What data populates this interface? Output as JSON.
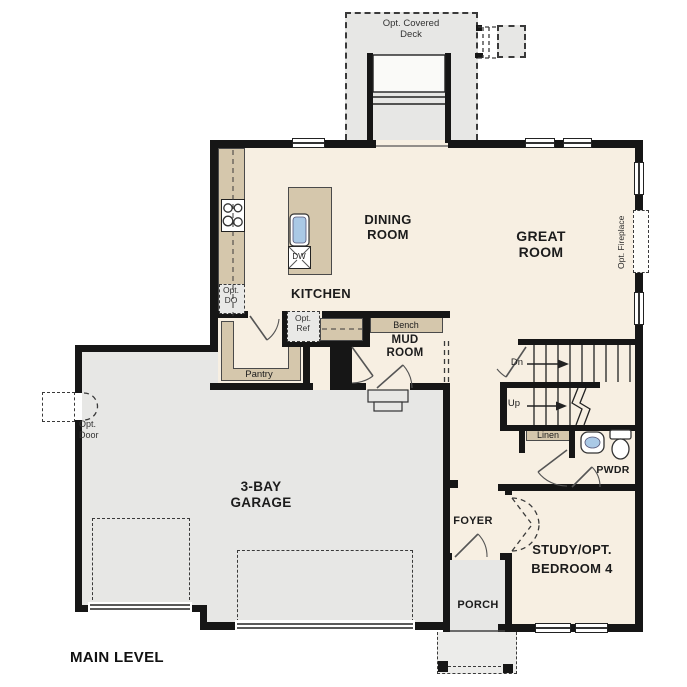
{
  "title": "MAIN LEVEL",
  "colors": {
    "floor": "#f7efe2",
    "garage_floor": "#e7e7e5",
    "cabinetry": "#d5c7ac",
    "wall": "#161616",
    "fixture_blue": "#aac9e6"
  },
  "rooms": {
    "kitchen": {
      "label": "KITCHEN"
    },
    "dining": {
      "line1": "DINING",
      "line2": "ROOM"
    },
    "great": {
      "line1": "GREAT",
      "line2": "ROOM"
    },
    "mud": {
      "line1": "MUD",
      "line2": "ROOM"
    },
    "garage": {
      "line1": "3-BAY",
      "line2": "GARAGE"
    },
    "foyer": {
      "label": "FOYER"
    },
    "porch": {
      "label": "PORCH"
    },
    "study": {
      "line1": "STUDY/OPT.",
      "line2": "BEDROOM 4"
    },
    "powder": {
      "label": "PWDR"
    }
  },
  "features": {
    "deck": {
      "line1": "Opt. Covered",
      "line2": "Deck"
    },
    "fireplace": {
      "label": "Opt. Fireplace"
    },
    "opt_door": {
      "line1": "Opt.",
      "line2": "Door"
    },
    "opt_double_oven": {
      "line1": "Opt.",
      "line2": "DO"
    },
    "opt_fridge": {
      "line1": "Opt.",
      "line2": "Ref"
    },
    "pantry": {
      "label": "Pantry"
    },
    "bench": {
      "label": "Bench"
    },
    "linen": {
      "label": "Linen"
    },
    "dishwasher": {
      "label": "DW"
    },
    "stair_down": {
      "label": "Dn"
    },
    "stair_up": {
      "label": "Up"
    }
  }
}
